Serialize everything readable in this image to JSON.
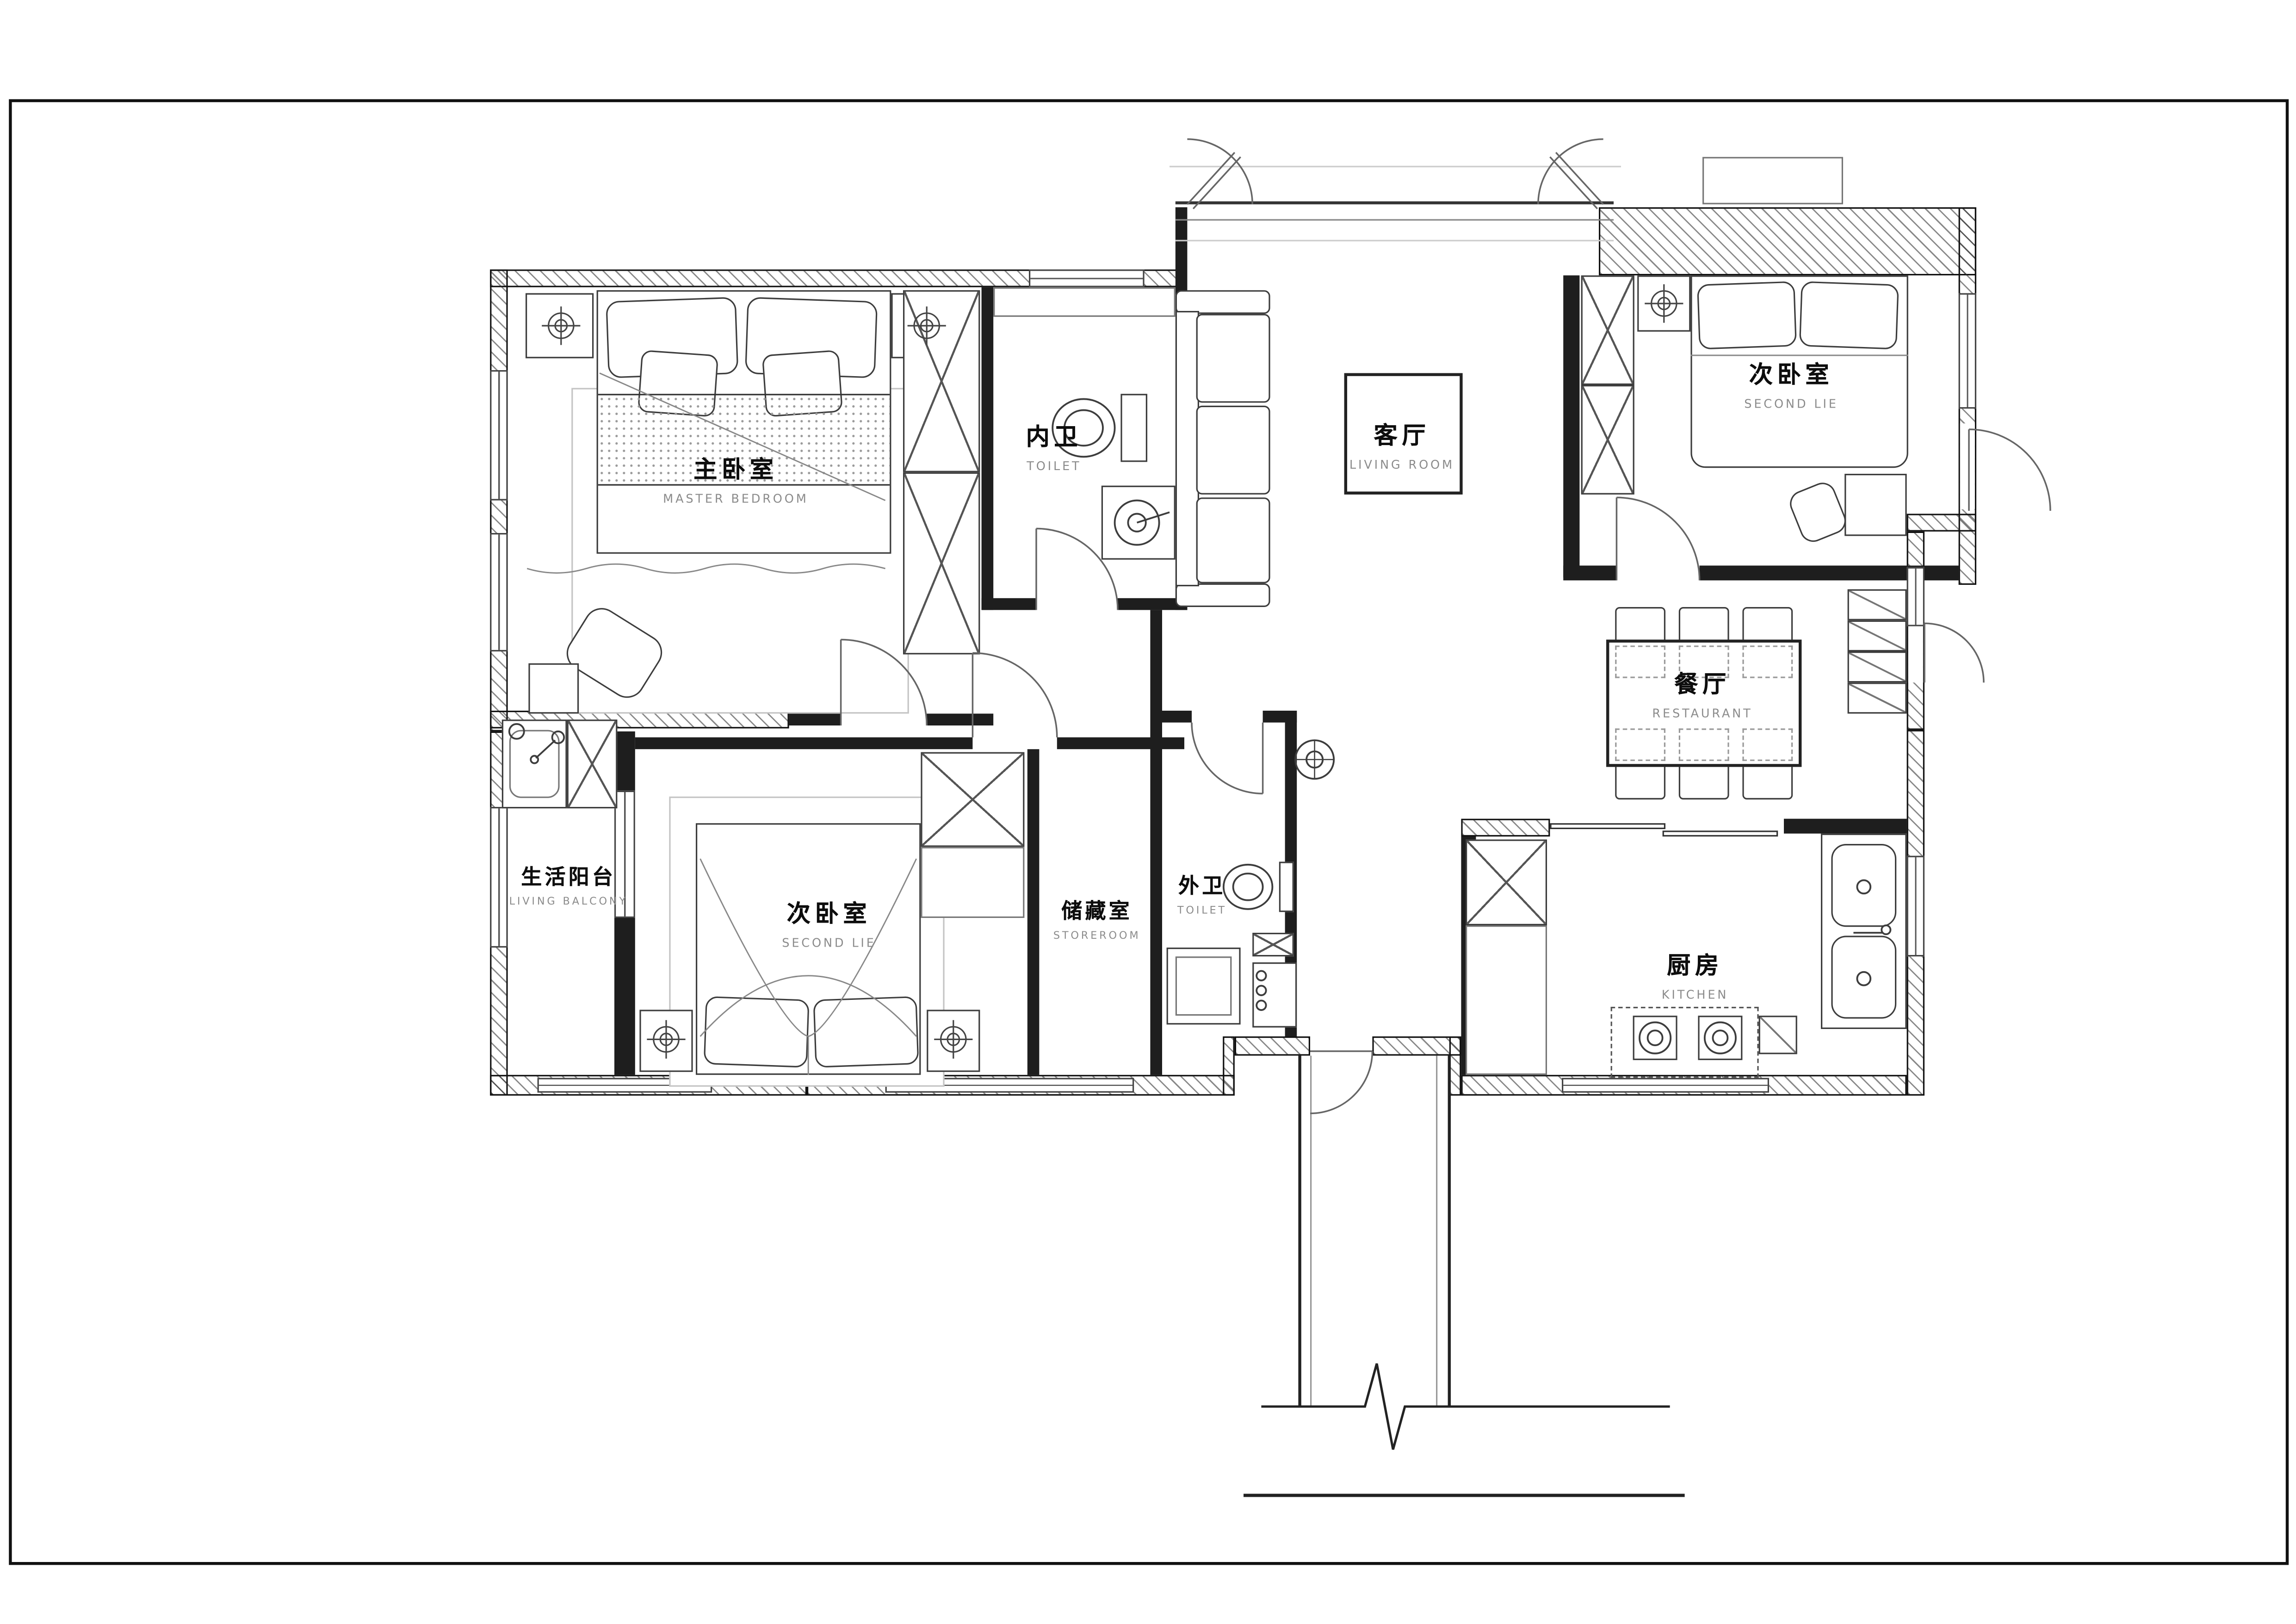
{
  "document": {
    "type": "apartment-floor-plan",
    "style": "CAD line drawing, black on white"
  },
  "rooms": [
    {
      "id": "master-bedroom",
      "zh": "主卧室",
      "en": "MASTER BEDROOM"
    },
    {
      "id": "toilet-inner",
      "zh": "内卫",
      "en": "TOILET"
    },
    {
      "id": "living-room",
      "zh": "客厅",
      "en": "LIVING ROOM"
    },
    {
      "id": "second-bedroom-top",
      "zh": "次卧室",
      "en": "SECOND LIE"
    },
    {
      "id": "restaurant",
      "zh": "餐厅",
      "en": "RESTAURANT"
    },
    {
      "id": "living-balcony",
      "zh": "生活阳台",
      "en": "LIVING BALCONY"
    },
    {
      "id": "second-bedroom-bottom",
      "zh": "次卧室",
      "en": "SECOND LIE"
    },
    {
      "id": "storeroom",
      "zh": "储藏室",
      "en": "STOREROOM"
    },
    {
      "id": "toilet-outer",
      "zh": "外卫",
      "en": "TOILET"
    },
    {
      "id": "kitchen",
      "zh": "厨房",
      "en": "KITCHEN"
    }
  ],
  "colors": {
    "paper": "#ffffff",
    "wall_line": "#111111",
    "label_zh": "#0d0d0d",
    "label_en": "#8b8b8b",
    "furniture_line": "#3d3d3d"
  }
}
